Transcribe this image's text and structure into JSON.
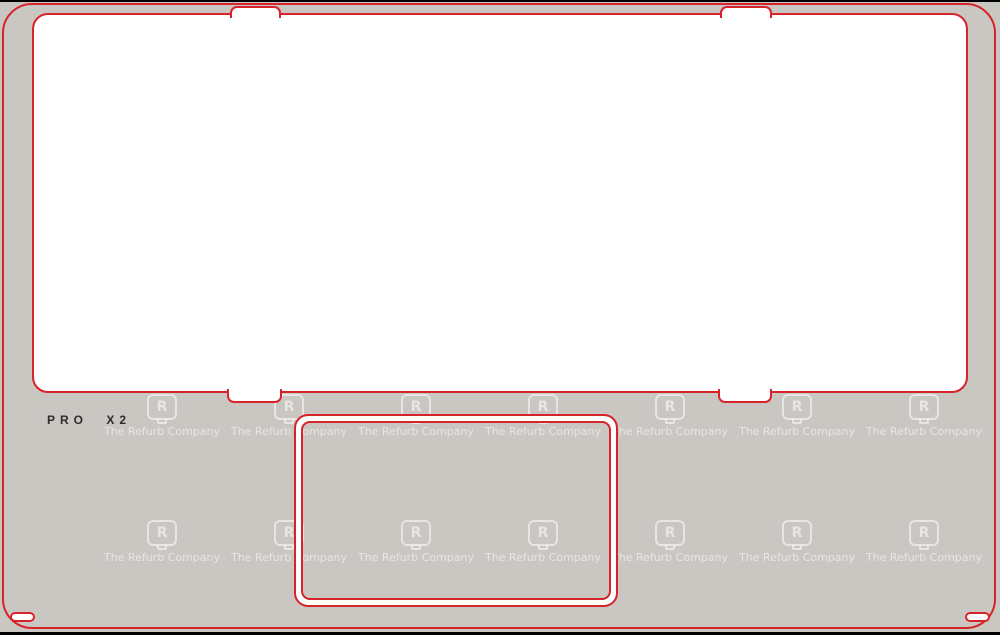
{
  "label": {
    "model": "PRO X2"
  },
  "watermark": {
    "brand_text": "The Refurb Company",
    "logo_letter": "R",
    "columns_x": [
      162,
      289,
      416,
      543,
      670,
      797,
      924
    ],
    "rows_y": [
      394,
      520
    ]
  },
  "colors": {
    "background": "#cac7c3",
    "cut_line": "#d7232a",
    "panel": "#ffffff",
    "letterbox": "#000000",
    "label_text": "#2d2d2d",
    "watermark": "rgba(255,255,255,0.55)"
  }
}
